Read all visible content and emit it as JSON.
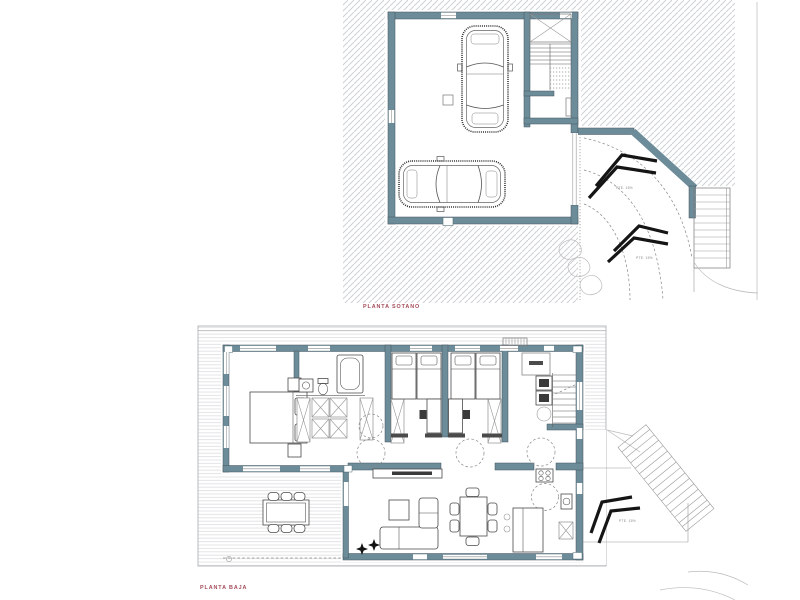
{
  "titles": {
    "basement": "PLANTA SOTANO",
    "ground": "PLANTA BAJA"
  },
  "annotations": {
    "basement_ramp_slope_1": "PTE. 15%",
    "basement_ramp_slope_2": "PTE. 15%",
    "ground_ramp_slope": "PTE. 15%"
  },
  "colors": {
    "wall_fill": "#6d8c99",
    "wall_edge": "#42545c",
    "title_text": "#a34b58",
    "annotation_text": "#8a8a8a",
    "hatch_line": "#cdd2d5",
    "stripe_line": "#e3e4e6",
    "arrow": "#151515",
    "background": "#ffffff"
  }
}
